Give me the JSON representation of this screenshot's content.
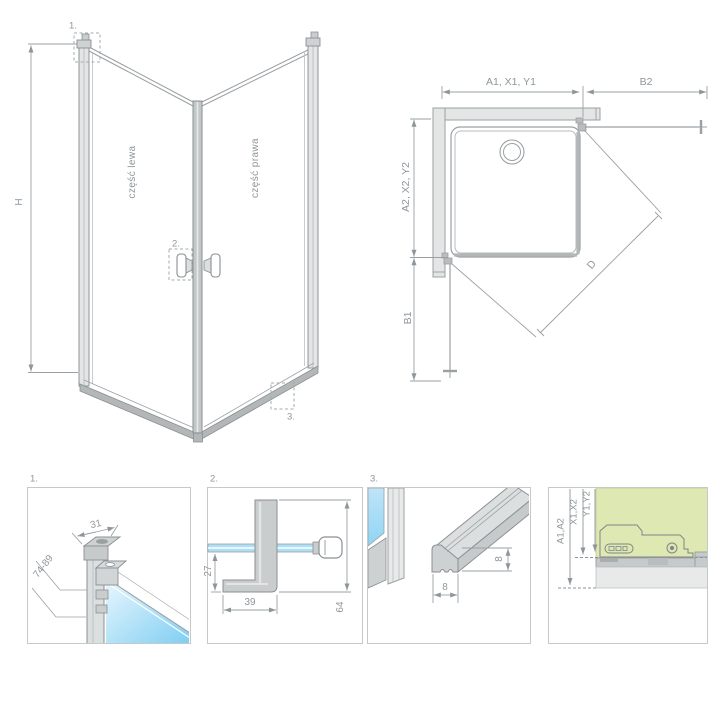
{
  "perspective_view": {
    "height_dim": "H",
    "left_part_label": "część lewa",
    "right_part_label": "część prawa",
    "detail_marker_1": "1.",
    "detail_marker_2": "2.",
    "detail_marker_3": "3."
  },
  "top_view": {
    "dim_width_left": "A1, X1, Y1",
    "dim_width_right": "B2",
    "dim_depth_upper": "A2, X2, Y2",
    "dim_depth_lower": "B1",
    "dim_diagonal": "D"
  },
  "detail_panels": {
    "panel_1": {
      "label": "1.",
      "dim_profile_width": "31",
      "dim_adjust_range": "74-89"
    },
    "panel_2": {
      "label": "2.",
      "dim_handle_drop": "27",
      "dim_handle_depth": "39",
      "dim_handle_height": "64"
    },
    "panel_3": {
      "label": "3.",
      "dim_rail_height": "8",
      "dim_rail_width": "8"
    },
    "panel_4": {
      "dim_a": "A1,A2",
      "dim_x": "X1,X2",
      "dim_y": "Y1,Y2"
    }
  },
  "colors": {
    "line_gray": "#9aa0a3",
    "text_gray": "#8f969a",
    "profile_fill": "#c9cdce",
    "glass_light": "#dcf1fc",
    "glass_strong": "#7fcef2",
    "wall_green": "#dde8b2"
  }
}
